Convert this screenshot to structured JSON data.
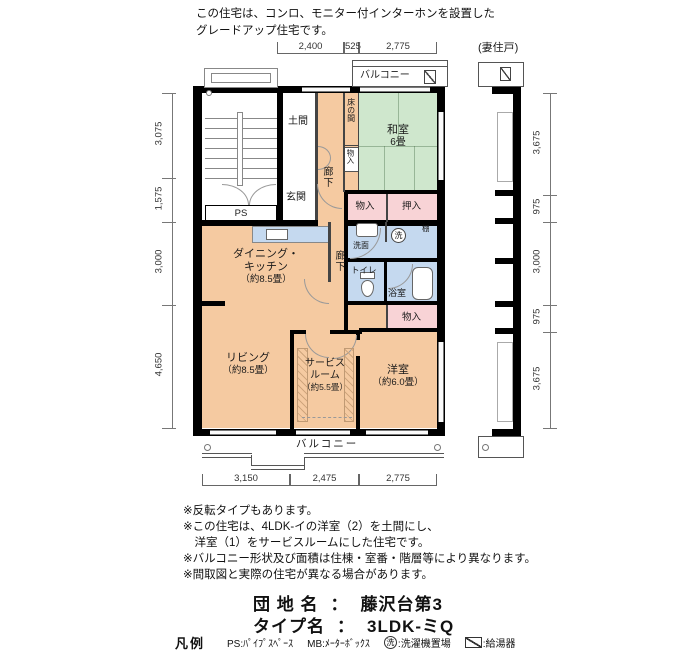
{
  "header": {
    "line1": "この住宅は、コンロ、モニター付インターホンを設置した",
    "line2": "グレードアップ住宅です。"
  },
  "plan": {
    "neighbor_label": "(妻住戸)",
    "rooms": {
      "ps": "PS",
      "doma": "土間",
      "genkan": "玄関",
      "rouka": "廊下",
      "tokonoma": "床の間",
      "washitsu": "和室",
      "washitsu_size": "6畳",
      "monoire": "物入",
      "oshiire": "押入",
      "senmen": "洗面",
      "washer": "洗",
      "tana": "棚",
      "toilet": "トイレ",
      "bath": "浴室",
      "dk1": "ダイニング・",
      "dk2": "キッチン",
      "dk_size": "（約8.5畳）",
      "living": "リビング",
      "living_size": "（約8.5畳）",
      "service1": "サービス",
      "service2": "ルーム",
      "service_size": "（約5.5畳）",
      "western": "洋室",
      "western_size": "（約6.0畳）",
      "balcony": "バルコニー"
    },
    "dims": {
      "top": [
        "2,400",
        "525",
        "2,775"
      ],
      "left": [
        "3,075",
        "1,575",
        "3,000",
        "4,650"
      ],
      "right": [
        "3,675",
        "975",
        "3,000",
        "975",
        "3,675"
      ],
      "bottom": [
        "3,150",
        "2,475",
        "2,775"
      ]
    }
  },
  "notes": [
    "※反転タイプもあります。",
    "※この住宅は、4LDK-イの洋室（2）を土間にし、",
    "　洋室（1）をサービスルームにした住宅です。",
    "※バルコニー形状及び面積は住棟・室番・階層等により異なります。",
    "※間取図と実際の住宅が異なる場合があります。"
  ],
  "title": {
    "row1_label": "団 地 名",
    "sep": "：",
    "row1_value": "藤沢台第3",
    "row2_label": "タイプ名",
    "row2_value": "3LDK-ミQ"
  },
  "legend": {
    "heading": "凡例",
    "ps": "PS:ﾊﾟｲﾌﾟｽﾍﾟｰｽ",
    "mb": "MB:ﾒｰﾀｰﾎﾞｯｸｽ",
    "washer": "洗",
    "washer_text": ":洗濯機置場",
    "heater_text": ":給湯器"
  },
  "colors": {
    "room": "#f5caa1",
    "tatami": "#cfe7cd",
    "water": "#c5d9ef",
    "closet": "#f8d3d6",
    "wall": "#000000"
  }
}
